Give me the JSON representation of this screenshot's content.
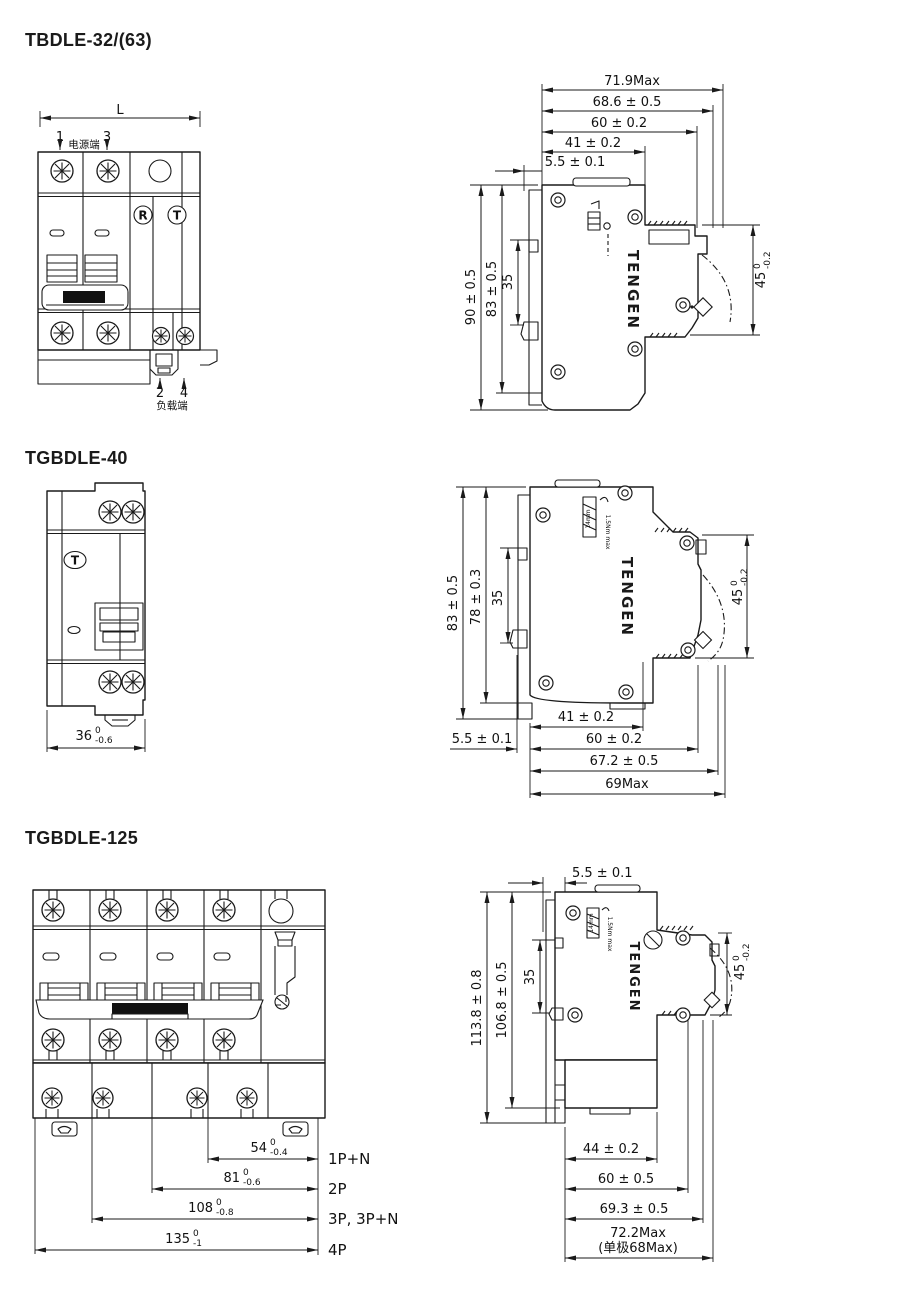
{
  "page": {
    "background": "#ffffff",
    "line_color": "#1a1a1a"
  },
  "s1": {
    "title": "TBDLE-32/(63)",
    "front": {
      "dim_l": "L",
      "n1": "1",
      "n3": "3",
      "top_label": "电源端",
      "r": "R",
      "t": "T",
      "n2": "2",
      "n4": "4",
      "bottom_label": "负载端"
    },
    "side": {
      "w1": "71.9Max",
      "w2": "68.6 ± 0.5",
      "w3": "60 ± 0.2",
      "w4": "41 ± 0.2",
      "w5": "5.5 ± 0.1",
      "h1": "90 ± 0.5",
      "h2": "83 ± 0.5",
      "h3": "35",
      "d_val": "45",
      "d_sup": "0",
      "d_sub": "-0.2",
      "brand": "TENGEN"
    }
  },
  "s2": {
    "title": "TGBDLE-40",
    "front": {
      "t": "T",
      "w_val": "36",
      "w_sup": "0",
      "w_sub": "-0.6"
    },
    "side": {
      "h1": "83 ± 0.5",
      "h2": "78 ± 0.3",
      "h3": "35",
      "d_val": "45",
      "d_sup": "0",
      "d_sub": "-0.2",
      "b1": "41 ± 0.2",
      "b2": "5.5 ± 0.1",
      "b3": "60 ± 0.2",
      "b4": "67.2 ± 0.5",
      "b5": "69Max",
      "strip": "14mm",
      "torque": "1.5Nm max",
      "brand": "TENGEN"
    }
  },
  "s3": {
    "title": "TGBDLE-125",
    "front": {
      "d1": {
        "val": "54",
        "sup": "0",
        "sub": "-0.4",
        "label": "1P+N"
      },
      "d2": {
        "val": "81",
        "sup": "0",
        "sub": "-0.6",
        "label": "2P"
      },
      "d3": {
        "val": "108",
        "sup": "0",
        "sub": "-0.8",
        "label": "3P, 3P+N"
      },
      "d4": {
        "val": "135",
        "sup": "0",
        "sub": "-1",
        "label": "4P"
      }
    },
    "side": {
      "t1": "5.5 ± 0.1",
      "h1": "113.8 ± 0.8",
      "h2": "106.8 ± 0.5",
      "h3": "35",
      "d_val": "45",
      "d_sup": "0",
      "d_sub": "-0.2",
      "b1": "44 ± 0.2",
      "b2": "60 ± 0.5",
      "b3": "69.3 ± 0.5",
      "b4": "72.2Max",
      "b5": "(单极68Max)",
      "strip": "14mm",
      "torque": "1.5Nm max",
      "brand": "TENGEN"
    }
  }
}
